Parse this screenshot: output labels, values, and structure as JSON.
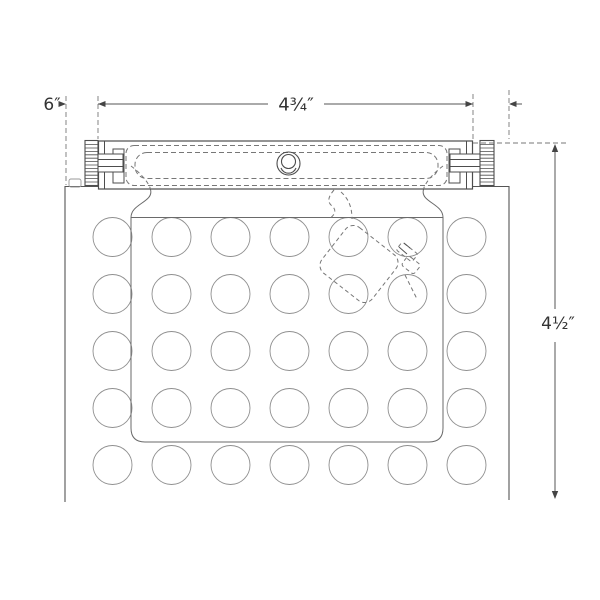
{
  "drawing": {
    "type": "technical dimension drawing",
    "subject": "wall fixture with dotted back panel, mounting bar and thumbscrews",
    "dimensions": {
      "overall_width": "6″",
      "bar_width": "4¾″",
      "overall_height": "4½″"
    },
    "dot_grid": {
      "columns": 7,
      "rows": 5
    },
    "colors": {
      "outline": "#4d4d4d",
      "hidden_line": "#777777",
      "dot": "#8f8f8f",
      "dimension": "#555555",
      "text": "#333333",
      "background": "#ffffff"
    }
  }
}
